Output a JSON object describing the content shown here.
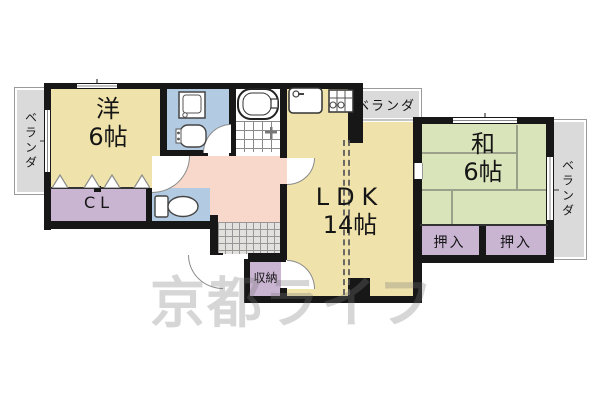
{
  "plan_title": "apartment floor plan",
  "rooms": {
    "western": {
      "name": "洋",
      "size": "6帖"
    },
    "ldk": {
      "name": "LDK",
      "size": "14帖"
    },
    "japanese": {
      "name": "和",
      "size": "6帖"
    }
  },
  "storage": {
    "cl": "CL",
    "oshiire_left": "押入",
    "oshiire_right": "押入",
    "shuno": "収納"
  },
  "verandas": {
    "left": "ベランダ",
    "top": "ベランダ",
    "right": "ベランダ"
  },
  "fixtures": {
    "washer": "washing-machine",
    "washbasin": "washbasin",
    "toilet": "toilet",
    "bathtub": "bathtub",
    "kitchen_sink": "kitchen-sink",
    "stove": "gas-stove"
  },
  "watermark": "京都ライフ",
  "colors": {
    "room_cream": "#efe2ab",
    "tatami_green": "#d9e4ba",
    "closet_lavender": "#c9b4d2",
    "wet_area_blue": "#b3cbe2",
    "hall_pink": "#f7d8ca",
    "veranda_gray": "#dadada",
    "wall_black": "#171717",
    "watermark_gray": "#c8c8c8"
  }
}
